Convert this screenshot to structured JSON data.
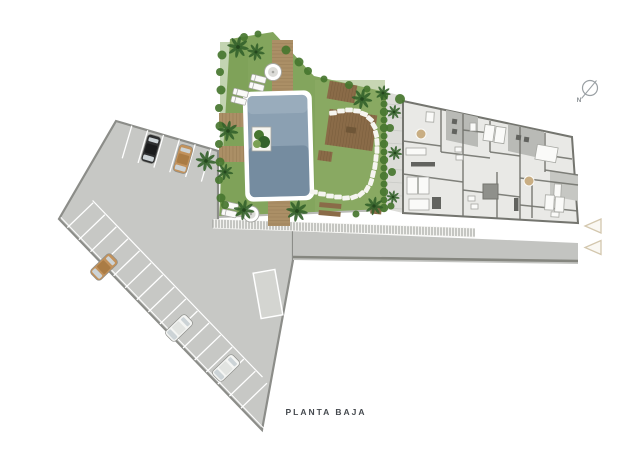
{
  "plan": {
    "title": "PLANTA BAJA"
  },
  "compass": {
    "label": "N"
  },
  "icons": {
    "compass": "compass-north-icon",
    "entry_arrows": "entrance-arrow-icon",
    "palm": "palm-tree-icon",
    "parasol": "parasol-icon"
  },
  "colors": {
    "background": "#ffffff",
    "parking": "#c7c8c5",
    "parkingEdge": "#8c8d89",
    "stallLine": "#ffffff",
    "ramp": "#d4d5d1",
    "road": "#c3c4c1",
    "curb": "#85867f",
    "hatchBg": "#f3f3f0",
    "hatchLine": "#979894",
    "grass": "#83a55d",
    "grassLight": "#8fae68",
    "grassDark": "#7aa054",
    "hedge": "#47762f",
    "palm": "#34622b",
    "palmDark": "#24471e",
    "poolRim": "#ffffff",
    "poolWater": "#8ba0b2",
    "poolDeep": "#647b92",
    "poolLight": "#a7b8c6",
    "deck": "#ab8f66",
    "deckLine": "#8f7650",
    "pergola": "#8a6b48",
    "pergolaDark": "#6f5637",
    "stone": "#f6f5f0",
    "floor": "#e9e9e6",
    "wall": "#74756f",
    "terrace": "#b9bab6",
    "terraceLight": "#c6c7c3",
    "fixture": "#fafaf8",
    "fixtureLine": "#a6a7a2",
    "counter": "#62635f",
    "elevator": "#8f908b",
    "woodAccent": "#c9ae83",
    "walkway": "#dcdcd8",
    "walkLine": "#c8c9c5",
    "carBlack": "#2e2f30",
    "carBlackRoof": "#1b1c1d",
    "carTan": "#c2925c",
    "carTanRoof": "#aa7c45",
    "carWhite": "#f4f5f3",
    "carWhiteRoof": "#e2e4e1",
    "carWindow": "#ccd3d6",
    "carOutline": "#8e8f8b",
    "compass": "#9aa0a4",
    "arrow": "#d3c7ae",
    "arrowFill": "#faf8f3",
    "title": "#45494e",
    "north": "#8b9094"
  }
}
